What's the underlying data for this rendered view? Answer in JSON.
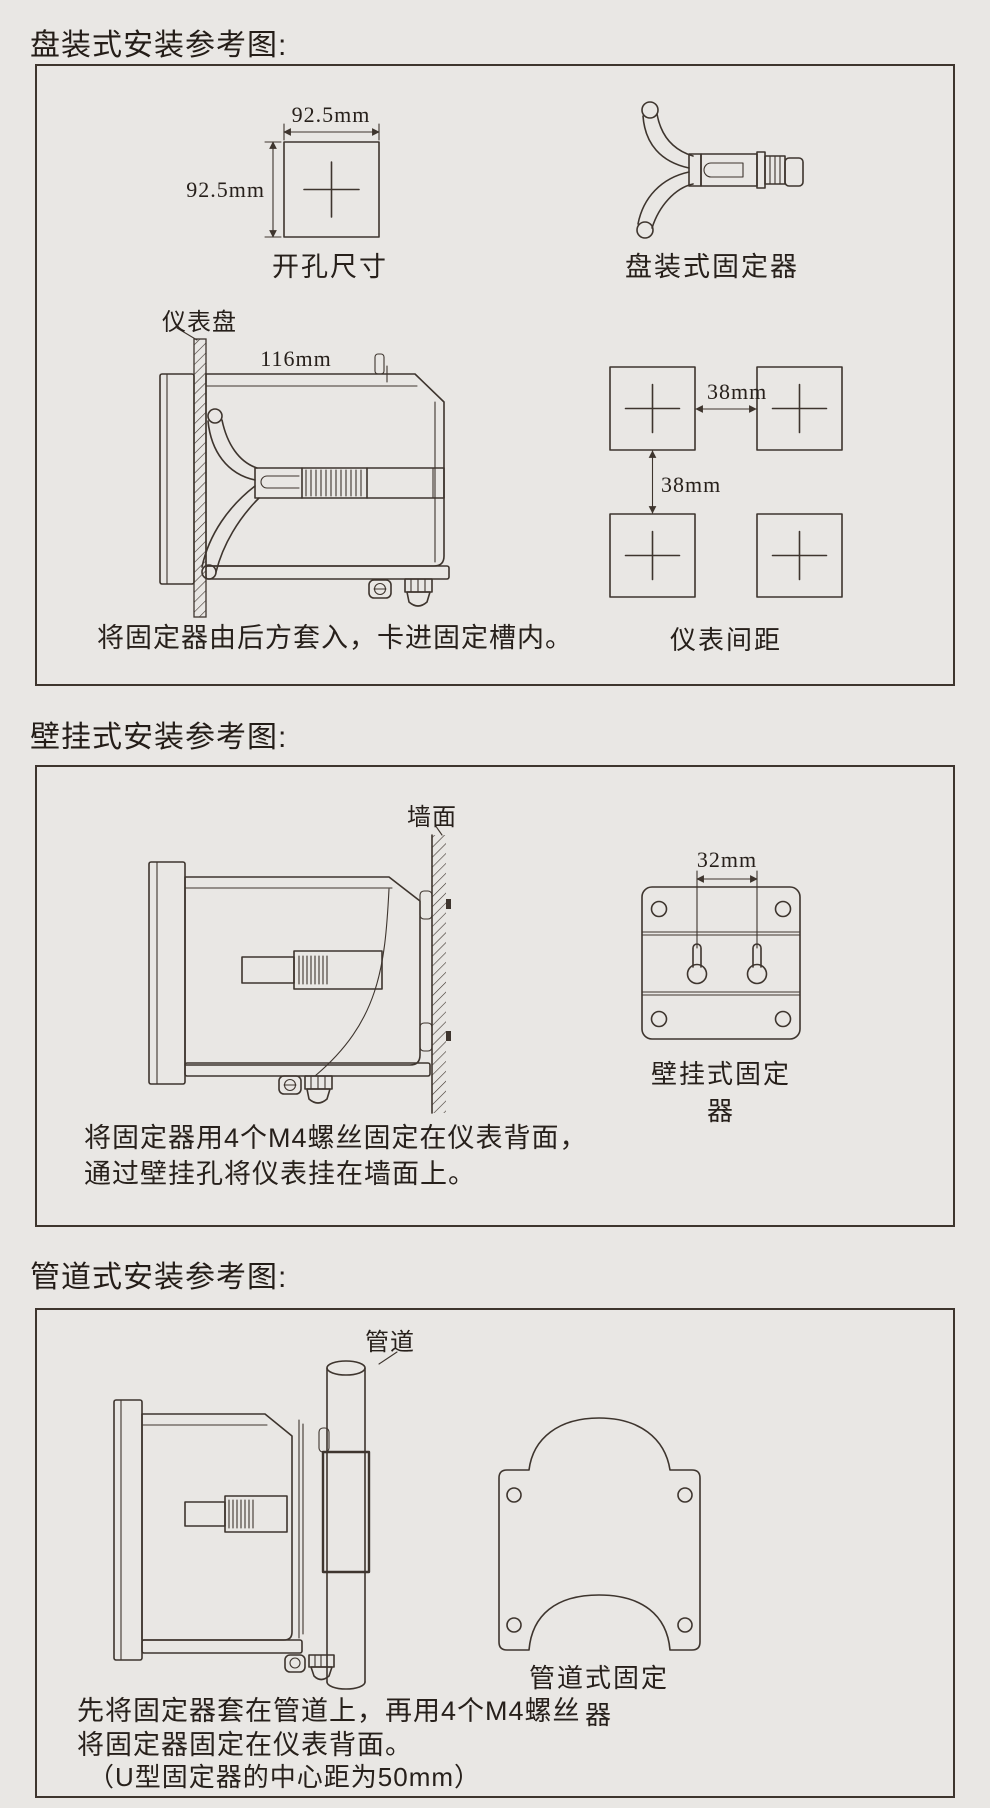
{
  "colors": {
    "background": "#e9e7e4",
    "line": "#3e352e",
    "text": "#27201b"
  },
  "sections": {
    "panel": {
      "title": "盘装式安装参考图:",
      "cutout_width": "92.5mm",
      "cutout_height": "92.5mm",
      "cutout_caption": "开孔尺寸",
      "fixture_caption": "盘装式固定器",
      "panel_label": "仪表盘",
      "depth_dim": "116mm",
      "instruction": "将固定器由后方套入，卡进固定槽内。",
      "spacing_h": "38mm",
      "spacing_v": "38mm",
      "spacing_caption": "仪表间距"
    },
    "wall": {
      "title": "壁挂式安装参考图:",
      "wall_label": "墙面",
      "hole_spacing": "32mm",
      "fixture_caption": "壁挂式固定器",
      "instruction_line1": "将固定器用4个M4螺丝固定在仪表背面，",
      "instruction_line2": "通过壁挂孔将仪表挂在墙面上。"
    },
    "pipe": {
      "title": "管道式安装参考图:",
      "pipe_label": "管道",
      "fixture_caption": "管道式固定器",
      "instruction_line1": "先将固定器套在管道上，再用4个M4螺丝",
      "instruction_line2": "将固定器固定在仪表背面。",
      "instruction_line3": "（U型固定器的中心距为50mm）"
    }
  }
}
